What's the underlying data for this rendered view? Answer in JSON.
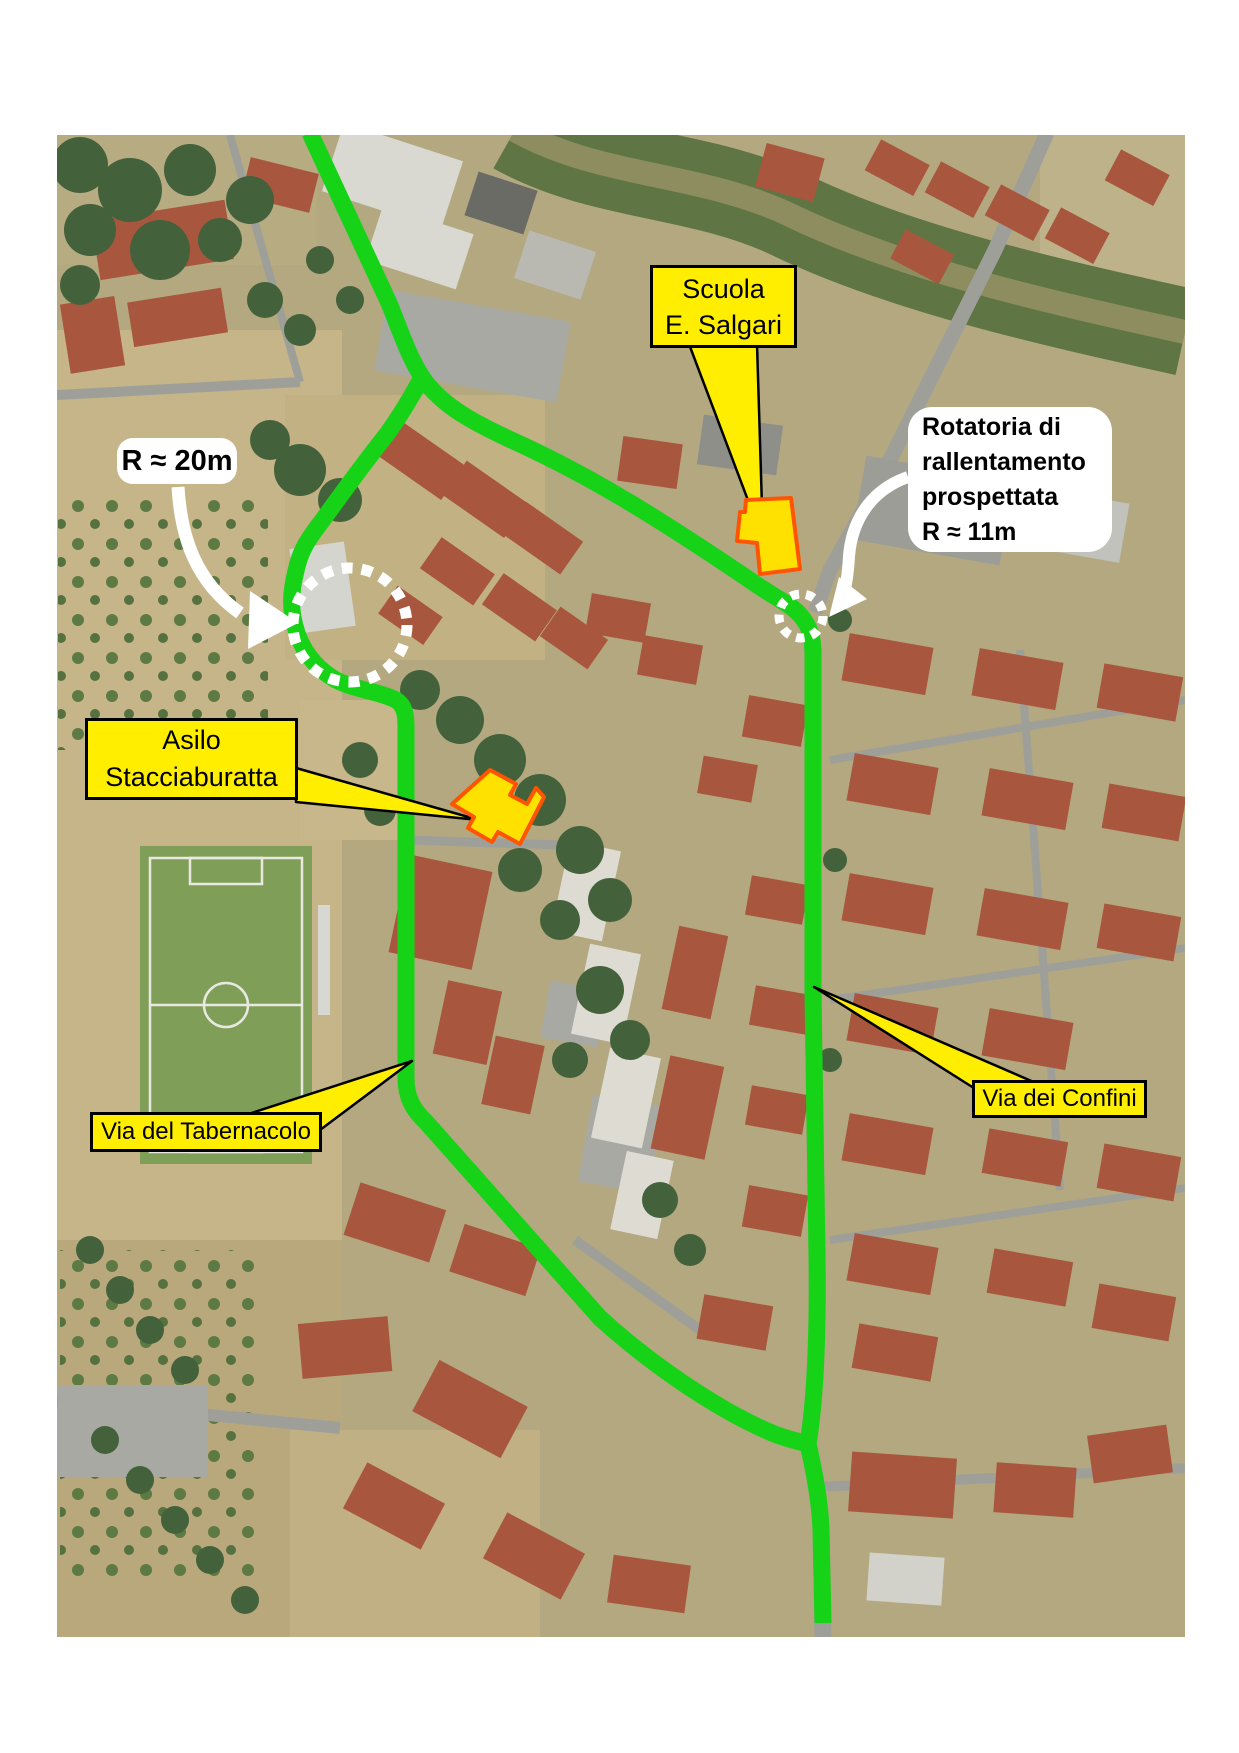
{
  "labels": {
    "scuola": {
      "lines": [
        "Scuola",
        "E. Salgari"
      ],
      "style": "yellow-box"
    },
    "rotatoria": {
      "lines": [
        "Rotatoria di",
        "rallentamento",
        "prospettata",
        "R ≈ 11m"
      ],
      "style": "white-rounded"
    },
    "r20": {
      "text": "R ≈ 20m",
      "style": "white-rounded"
    },
    "asilo": {
      "lines": [
        "Asilo",
        "Stacciaburatta"
      ],
      "style": "yellow-box"
    },
    "tabernacolo": {
      "text": "Via del Tabernacolo",
      "style": "yellow-box"
    },
    "confini": {
      "text": "Via dei Confini",
      "style": "yellow-box"
    }
  },
  "colors": {
    "route_highlight": "#17d317",
    "label_yellow": "#ffee00",
    "label_border": "#000000",
    "label_white": "#ffffff",
    "building_highlight_fill": "#ffe100",
    "building_highlight_outline": "#ff5500",
    "dotted_circle": "#ffffff",
    "arrow_white": "#ffffff"
  }
}
